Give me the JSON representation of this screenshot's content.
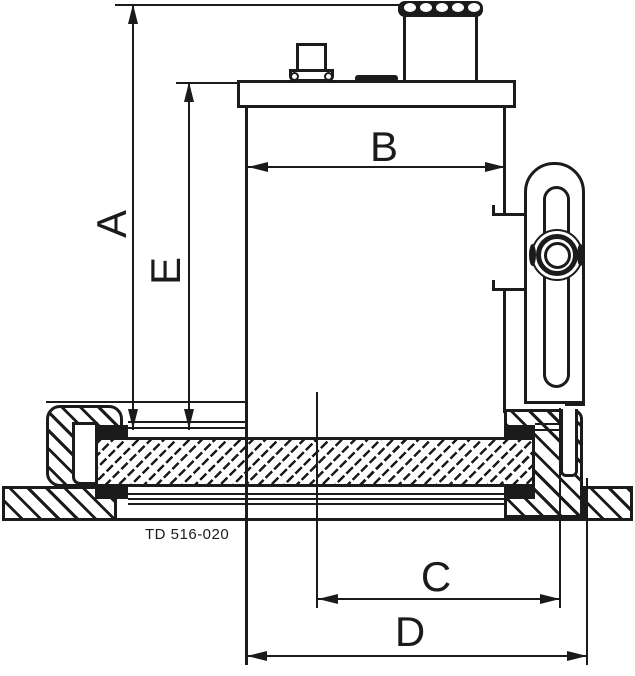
{
  "diagram": {
    "description": "Technical sectional dimensional drawing of a tank-bottom instrument with clamp flange",
    "drawing_number": "TD 516-020",
    "dimensions": {
      "A": "A",
      "B": "B",
      "C": "C",
      "D": "D",
      "E": "E"
    },
    "colors": {
      "ink": "#1b1b1b",
      "background": "#ffffff"
    }
  }
}
